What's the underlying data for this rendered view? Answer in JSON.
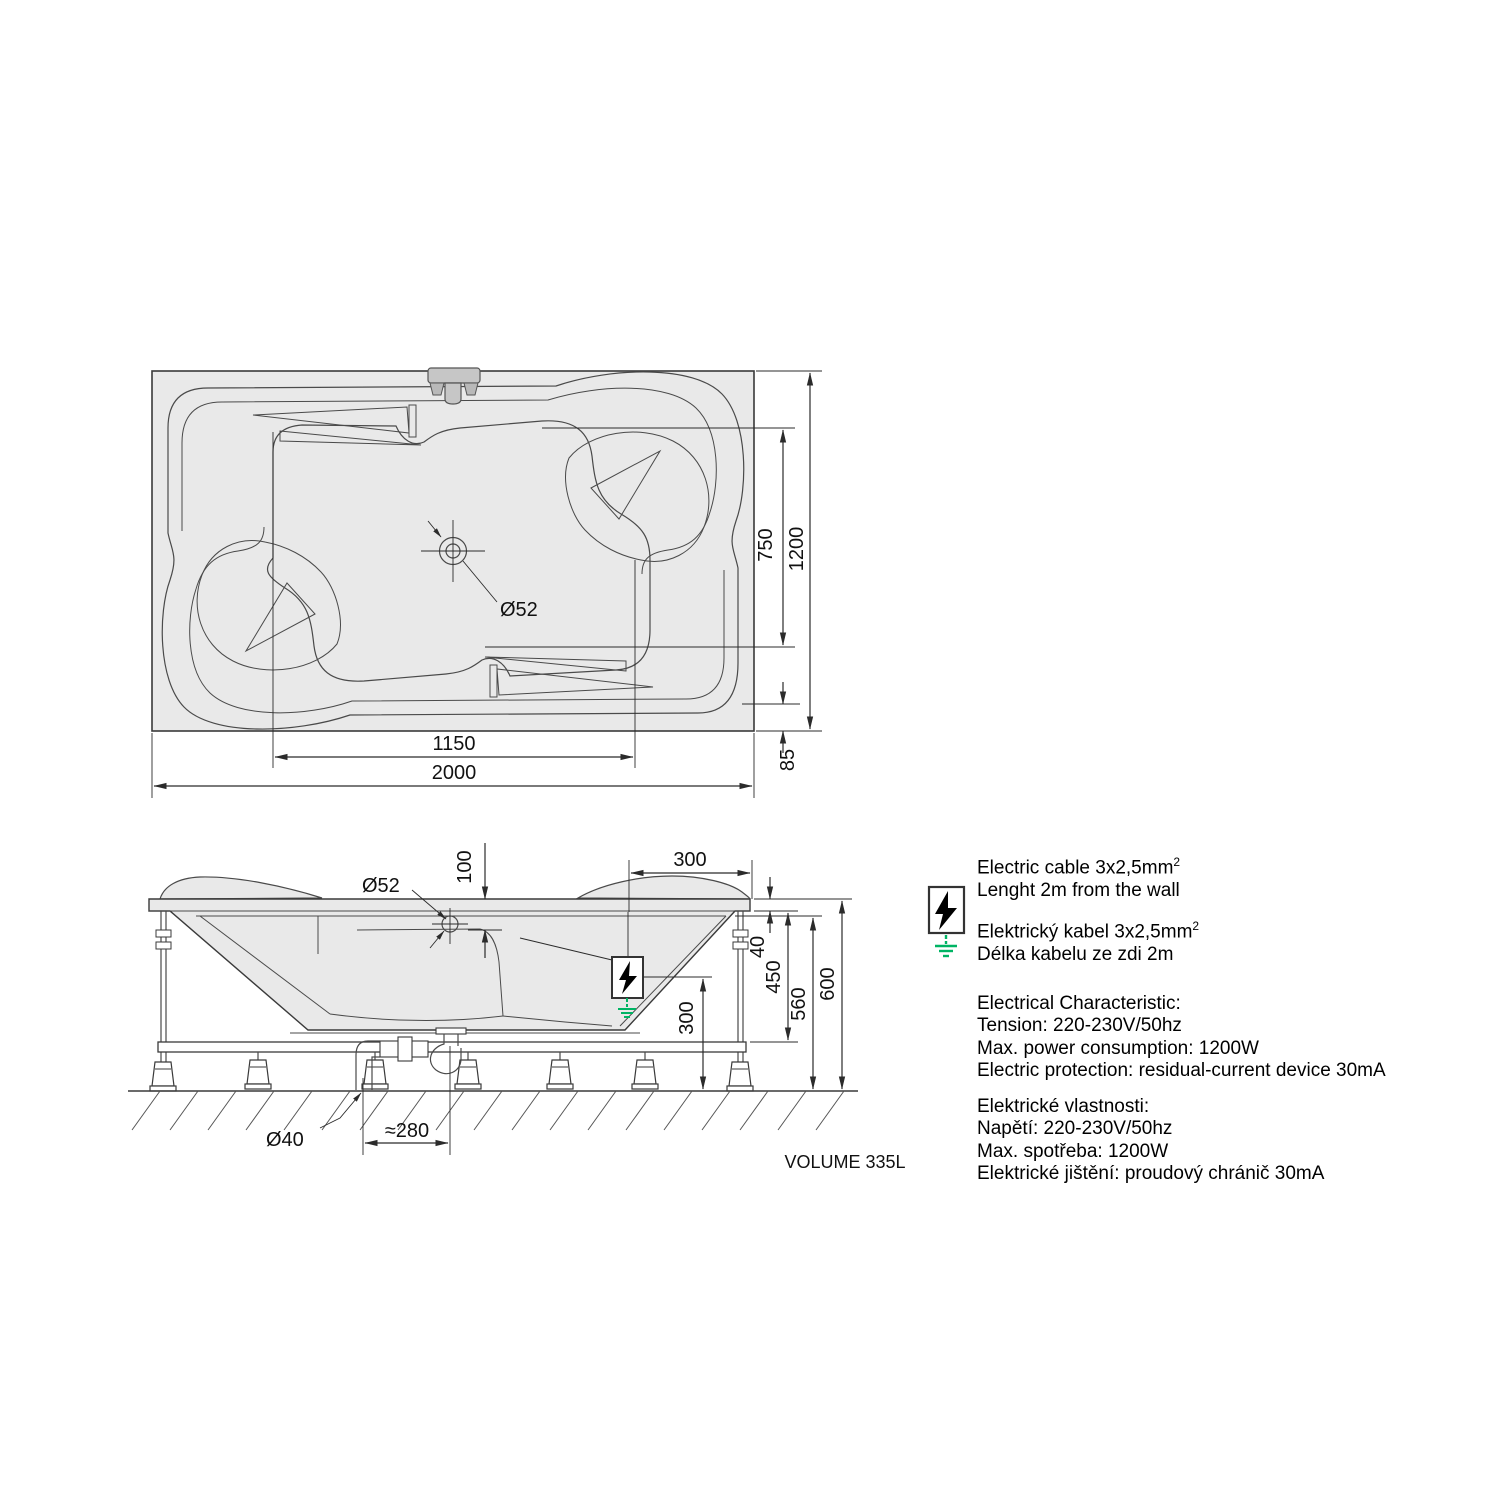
{
  "top_view": {
    "dims": {
      "overall_length": "2000",
      "drain_length_offset": "1150",
      "overall_width": "1200",
      "inner_width": "750",
      "edge_offset": "85",
      "drain_diameter": "Ø52"
    }
  },
  "side_view": {
    "dims": {
      "drain_diameter": "Ø52",
      "rim_to_seat_depth": "100",
      "headrest_width": "300",
      "rim_thickness": "40",
      "rim_to_frame_height": "450",
      "under_rim_height": "560",
      "total_height": "600",
      "cable_exit_height": "300",
      "waste_pipe_diameter": "Ø40",
      "trap_offset": "≈280"
    },
    "volume_label": "VOLUME 335L"
  },
  "notes": {
    "cable_en_1": "Electric cable 3x2,5mm",
    "cable_en_1_sup": "2",
    "cable_en_2": "Lenght 2m from the wall",
    "cable_cz_1": "Elektrický kabel 3x2,5mm",
    "cable_cz_1_sup": "2",
    "cable_cz_2": "Délka kabelu ze zdi 2m",
    "en_title": "Electrical Characteristic:",
    "en_tension": "Tension: 220-230V/50hz",
    "en_power": "Max. power consumption: 1200W",
    "en_protection": "Electric protection: residual-current device 30mA",
    "cz_title": "Elektrické vlastnosti:",
    "cz_tension": "Napětí: 220-230V/50hz",
    "cz_power": "Max. spotřeba: 1200W",
    "cz_protection": "Elektrické jištění: proudový chránič 30mA"
  },
  "colors": {
    "line": "#2b2b2b",
    "tub_fill": "#e9e9e9",
    "ground_green": "#00b464",
    "faucet_gray": "#c6c6c6"
  }
}
